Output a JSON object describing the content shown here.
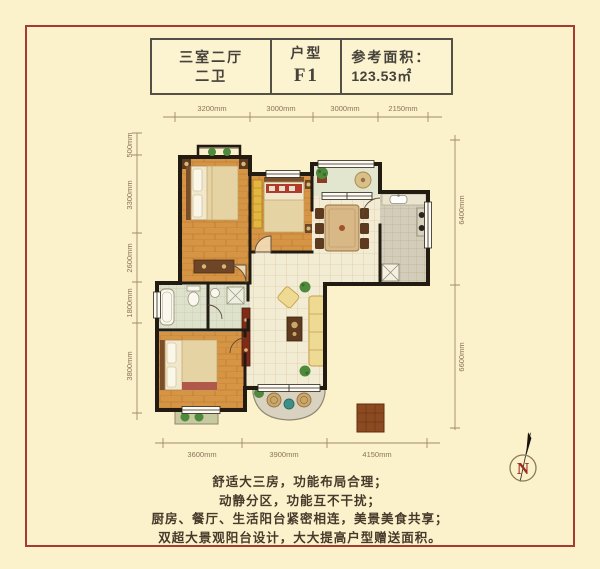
{
  "header": {
    "cells": [
      {
        "line1": "三室二厅",
        "line2": "二卫"
      },
      {
        "line1": "户型",
        "line2": "F1"
      },
      {
        "line1": "参考面积：",
        "line2": "123.53㎡"
      }
    ]
  },
  "dimensions": {
    "top": [
      "3200mm",
      "3000mm",
      "3000mm",
      "2150mm"
    ],
    "bottom": [
      "3600mm",
      "3900mm",
      "4150mm"
    ],
    "left": [
      "500mm",
      "3300mm",
      "2600mm",
      "1800mm",
      "3800mm"
    ],
    "right": [
      "6400mm",
      "6600mm"
    ]
  },
  "compass": {
    "label": "N"
  },
  "description": {
    "lines": [
      "舒适大三房，功能布局合理；",
      "动静分区，功能互不干扰；",
      "厨房、餐厅、生活阳台紧密相连，美景美食共享；",
      "双超大景观阳台设计，大大提高户型赠送面积。"
    ]
  },
  "colors": {
    "background": "#FBF1CB",
    "frame": "#A63C2F",
    "wall": "#221B12",
    "wood_floor": "#D69445",
    "tile_floor": "#F3ECD4",
    "dimension_text": "#8B7358"
  }
}
